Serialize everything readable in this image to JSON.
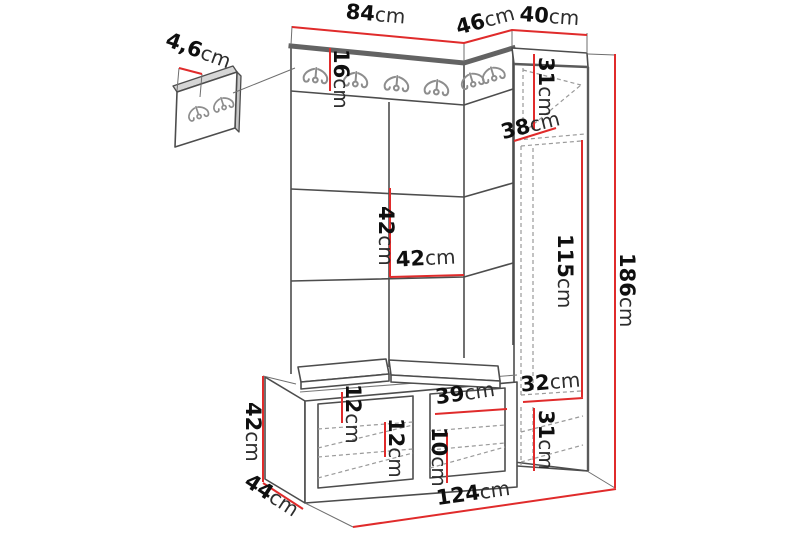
{
  "diagram": {
    "kind": "hallway furniture set dimensional drawing",
    "colors": {
      "dimension_line": "#e02b2b",
      "dashed": "#9a9a9a",
      "hook": "#8d8d8d"
    },
    "dimensions": {
      "detail_panel_depth": {
        "value": "4,6",
        "unit": "cm"
      },
      "wall_panel_width": {
        "value": "84",
        "unit": "cm"
      },
      "corner_panel_width": {
        "value": "46",
        "unit": "cm"
      },
      "cabinet_width": {
        "value": "40",
        "unit": "cm"
      },
      "hook_rail_height": {
        "value": "16",
        "unit": "cm"
      },
      "cabinet_top_section": {
        "value": "31",
        "unit": "cm"
      },
      "cabinet_depth": {
        "value": "38",
        "unit": "cm"
      },
      "tile_height": {
        "value": "42",
        "unit": "cm"
      },
      "tile_width": {
        "value": "42",
        "unit": "cm"
      },
      "door_height": {
        "value": "115",
        "unit": "cm"
      },
      "total_height": {
        "value": "186",
        "unit": "cm"
      },
      "cabinet_bottom_width": {
        "value": "32",
        "unit": "cm"
      },
      "cabinet_bottom_height": {
        "value": "31",
        "unit": "cm"
      },
      "bench_top_inset": {
        "value": "12",
        "unit": "cm"
      },
      "bench_shelf_spacing": {
        "value": "12",
        "unit": "cm"
      },
      "bench_opening_width": {
        "value": "39",
        "unit": "cm"
      },
      "bench_shoe_space": {
        "value": "10",
        "unit": "cm"
      },
      "bench_height": {
        "value": "42",
        "unit": "cm"
      },
      "bench_depth": {
        "value": "44",
        "unit": "cm"
      },
      "total_width": {
        "value": "124",
        "unit": "cm"
      }
    }
  }
}
